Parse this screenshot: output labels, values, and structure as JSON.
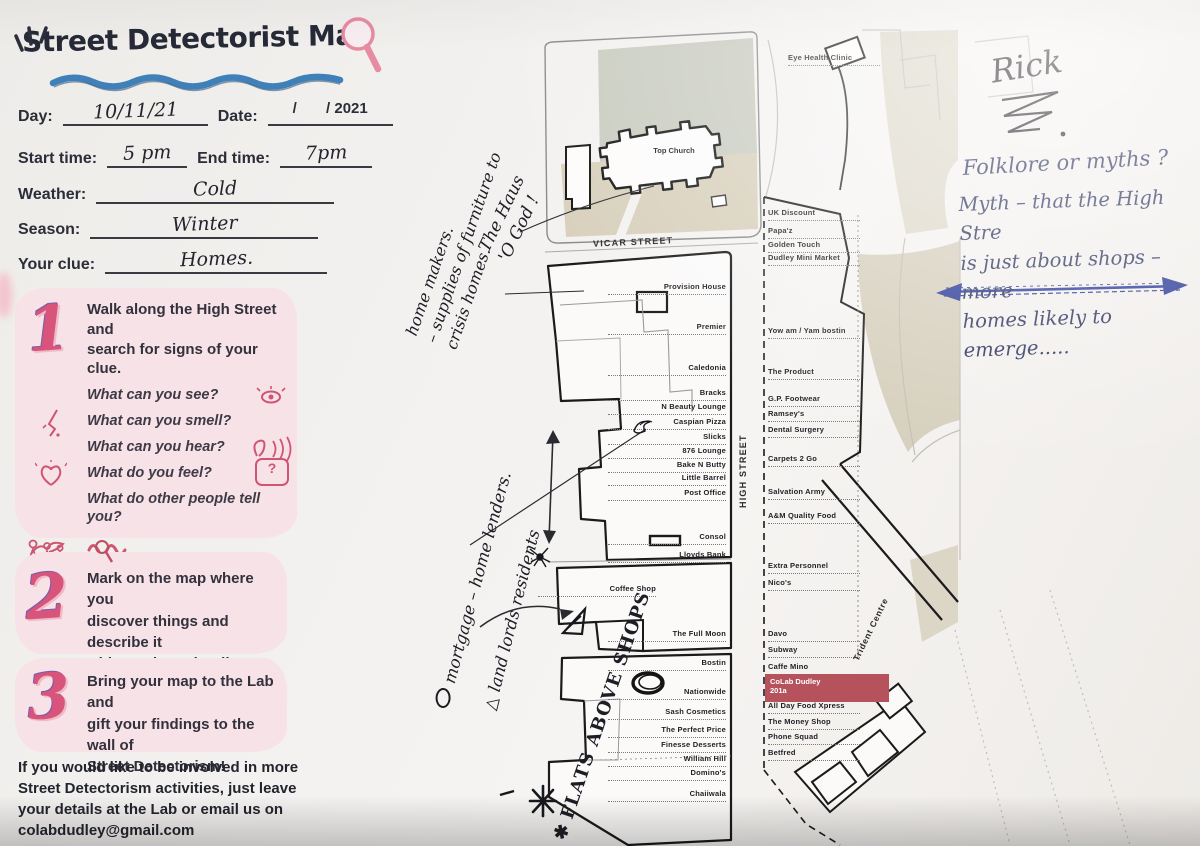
{
  "header": {
    "title": "Street Detectorist Map",
    "version_badge": "v2"
  },
  "form": {
    "day_label": "Day:",
    "day_value": "10/11/21",
    "date_label": "Date:",
    "date_value": "/       / 2021",
    "start_label": "Start time:",
    "start_value": "5 pm",
    "end_label": "End time:",
    "end_value": "7pm",
    "weather_label": "Weather:",
    "weather_value": "Cold",
    "season_label": "Season:",
    "season_value": "Winter",
    "clue_label": "Your clue:",
    "clue_value": "Homes."
  },
  "steps": {
    "one": {
      "number": "1",
      "intro": "Walk along the High Street and\nsearch for signs of your clue.",
      "q_see": "What can you see?",
      "q_smell": "What can you smell?",
      "q_hear": "What can you hear?",
      "q_feel": "What do you feel?",
      "q_tell": "What do other people tell you?",
      "q_notice": "What do you notice if you\nimagine you are a worm / a bird\n/ somebody else?",
      "bubble_text": "?"
    },
    "two": {
      "number": "2",
      "text": "Mark on the map where you\ndiscover things and describe it\nwith words or doodles."
    },
    "three": {
      "number": "3",
      "text": "Bring your map to the Lab and\ngift your findings to the wall of\nStreet Detectorism!"
    }
  },
  "footer": {
    "text": "If you would like to be involved in more\nStreet Detectorism activities, just leave\nyour details at the Lab or email us on\ncolabdudley@gmail.com"
  },
  "map": {
    "streets": {
      "vicar": "VICAR STREET",
      "high": "HIGH STREET",
      "trident": "Trident Centre"
    },
    "church": "Top Church",
    "colab": {
      "line1": "CoLab Dudley",
      "line2": "201a",
      "highlight_color": "#b5525c"
    },
    "left_buildings": [
      {
        "label": "Provision House",
        "top": 282
      },
      {
        "label": "Premier",
        "top": 322
      },
      {
        "label": "Caledonia",
        "top": 363
      },
      {
        "label": "Bracks",
        "top": 388
      },
      {
        "label": "N Beauty Lounge",
        "top": 402
      },
      {
        "label": "Caspian Pizza",
        "top": 417
      },
      {
        "label": "Slicks",
        "top": 432
      },
      {
        "label": "876 Lounge",
        "top": 446
      },
      {
        "label": "Bake N Butty",
        "top": 460
      },
      {
        "label": "Little Barrel",
        "top": 473
      },
      {
        "label": "Post Office",
        "top": 488
      },
      {
        "label": "Consol",
        "top": 532
      },
      {
        "label": "Lloyds Bank",
        "top": 550
      },
      {
        "label": "Coffee Shop",
        "top": 584,
        "left": 552,
        "w": 104
      },
      {
        "label": "The Full Moon",
        "top": 629
      },
      {
        "label": "Bostin",
        "top": 658
      },
      {
        "label": "Nationwide",
        "top": 687
      },
      {
        "label": "Sash Cosmetics",
        "top": 707
      },
      {
        "label": "The Perfect Price",
        "top": 725
      },
      {
        "label": "Finesse Desserts",
        "top": 740
      },
      {
        "label": "William Hill",
        "top": 754
      },
      {
        "label": "Domino's",
        "top": 768
      },
      {
        "label": "Chaiiwala",
        "top": 789
      }
    ],
    "right_buildings": [
      {
        "label": "Eye Health Clinic",
        "top": 53,
        "left": 788,
        "w": 110
      },
      {
        "label": "UK Discount",
        "top": 208
      },
      {
        "label": "Papa'z",
        "top": 226
      },
      {
        "label": "Golden Touch",
        "top": 240
      },
      {
        "label": "Dudley Mini Market",
        "top": 253
      },
      {
        "label": "Yow am / Yam bostin",
        "top": 326
      },
      {
        "label": "The Product",
        "top": 367
      },
      {
        "label": "G.P. Footwear",
        "top": 394
      },
      {
        "label": "Ramsey's",
        "top": 409
      },
      {
        "label": "Dental Surgery",
        "top": 425
      },
      {
        "label": "Carpets 2 Go",
        "top": 454
      },
      {
        "label": "Salvation Army",
        "top": 487
      },
      {
        "label": "A&M Quality Food",
        "top": 511
      },
      {
        "label": "Extra Personnel",
        "top": 561
      },
      {
        "label": "Nico's",
        "top": 578
      },
      {
        "label": "Davo",
        "top": 629
      },
      {
        "label": "Subway",
        "top": 645
      },
      {
        "label": "Caffe Mino",
        "top": 662
      },
      {
        "label": "All Day Food Xpress",
        "top": 701
      },
      {
        "label": "The Money Shop",
        "top": 717
      },
      {
        "label": "Phone Squad",
        "top": 732
      },
      {
        "label": "Betfred",
        "top": 748
      }
    ]
  },
  "annotations": {
    "home_makers": "home makers.\n– supplies of furniture to\ncrisis homes.",
    "haus_o_god": "The Haus\n'O God !",
    "legend_mortgage": "mortgage – home lenders.",
    "legend_landlords": "land lords residents",
    "legend_flats": "FLATS ABOVE SHOPS",
    "rick": "Rick",
    "folklore": "Folklore or myths ?",
    "myth": "Myth – that the High Stre\nis just about shops – more\nhomes likely to emerge.....",
    "symbols": {
      "triangle": "△",
      "star": "✱"
    }
  },
  "colors": {
    "box_pink": "#f7e2e8",
    "numeral_pink": "#d8547a",
    "wave_blue": "#3f80b8",
    "map_highlight": "#b5525c",
    "pen_blue": "#2e3560",
    "ink": "#1d1e25",
    "beige": "#d6cfbd",
    "green_gray": "#c9ccc0"
  }
}
